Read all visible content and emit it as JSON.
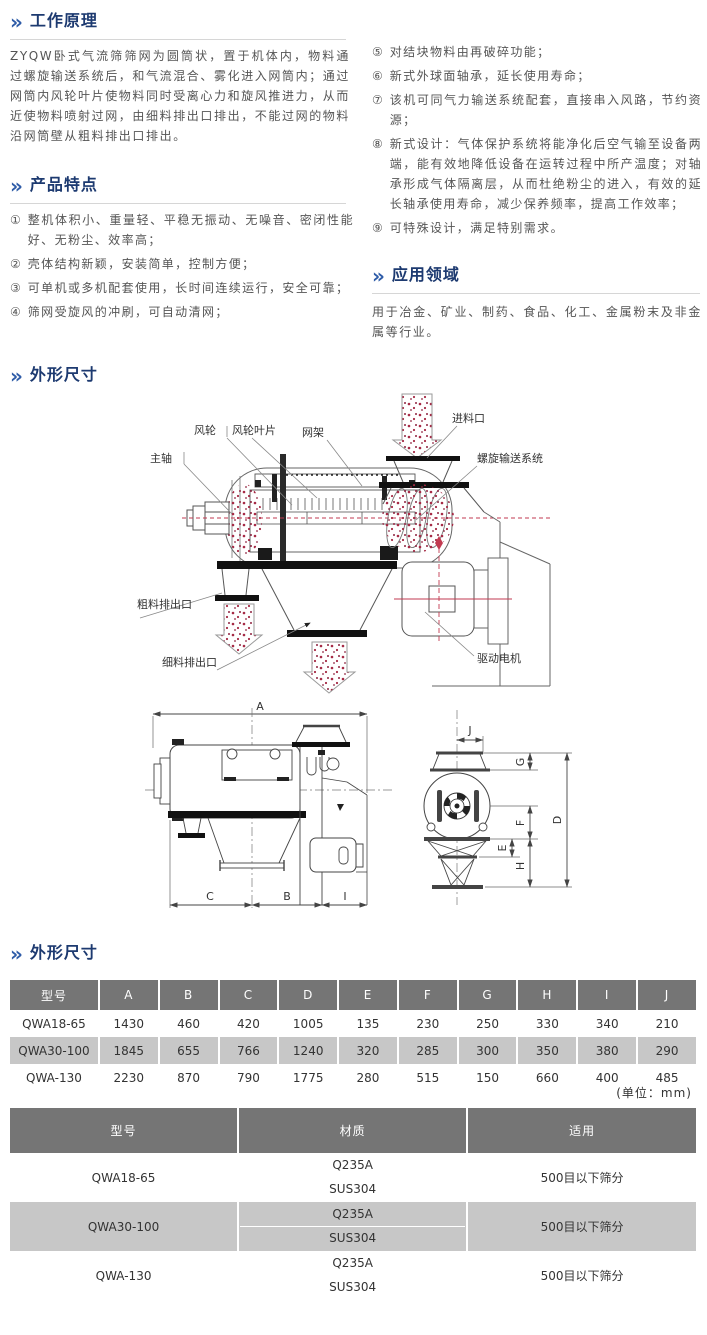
{
  "icons": {
    "chevron": "»"
  },
  "colors": {
    "heading": "#1d3a70",
    "chevron_blue": "#2e5ca8",
    "table_header_bg": "#757575",
    "table_row_gray": "#c7c7c7",
    "red_accent": "#c23a50"
  },
  "sections": {
    "working_principle": {
      "title": "工作原理",
      "body": "ZYQW卧式气流筛筛网为圆筒状，置于机体内，物料通过螺旋输送系统后，和气流混合、雾化进入网筒内；通过网筒内风轮叶片使物料同时受离心力和旋风推进力，从而近使物料喷射过网，由细料排出口排出，不能过网的物料沿网筒壁从粗料排出口排出。"
    },
    "features": {
      "title": "产品特点",
      "items": [
        {
          "marker": "①",
          "text": "整机体积小、重量轻、平稳无振动、无噪音、密闭性能好、无粉尘、效率高；"
        },
        {
          "marker": "②",
          "text": "壳体结构新颖，安装简单，控制方便；"
        },
        {
          "marker": "③",
          "text": "可单机或多机配套使用，长时间连续运行，安全可靠；"
        },
        {
          "marker": "④",
          "text": "筛网受旋风的冲刷，可自动清网；"
        },
        {
          "marker": "⑤",
          "text": "对结块物料由再破碎功能；"
        },
        {
          "marker": "⑥",
          "text": "新式外球面轴承，延长使用寿命；"
        },
        {
          "marker": "⑦",
          "text": "该机可同气力输送系统配套，直接串入风路，节约资源；"
        },
        {
          "marker": "⑧",
          "text": "新式设计：气体保护系统将能净化后空气输至设备两端，能有效地降低设备在运转过程中所产温度；对轴承形成气体隔离层，从而杜绝粉尘的进入，有效的延长轴承使用寿命，减少保养频率，提高工作效率；"
        },
        {
          "marker": "⑨",
          "text": "可特殊设计，满足特别需求。"
        }
      ]
    },
    "applications": {
      "title": "应用领域",
      "body": "用于冶金、矿业、制药、食品、化工、金属粉末及非金属等行业。"
    },
    "outline_dims": {
      "title": "外形尺寸"
    },
    "outline_dims2": {
      "title": "外形尺寸"
    }
  },
  "diagram1": {
    "labels": {
      "main_shaft": "主轴",
      "wind_wheel": "风轮",
      "wind_wheel_blades": "风轮叶片",
      "net_frame": "网架",
      "feed_inlet": "进料口",
      "screw_conveyor": "螺旋输送系统",
      "coarse_outlet": "粗料排出口",
      "fine_outlet": "细料排出口",
      "drive_motor": "驱动电机"
    }
  },
  "diagram2": {
    "letters": [
      "A",
      "B",
      "C",
      "D",
      "E",
      "F",
      "G",
      "H",
      "I",
      "J"
    ]
  },
  "dim_table": {
    "headers": [
      "型号",
      "A",
      "B",
      "C",
      "D",
      "E",
      "F",
      "G",
      "H",
      "I",
      "J"
    ],
    "rows": [
      {
        "model": "QWA18-65",
        "values": [
          "1430",
          "460",
          "420",
          "1005",
          "135",
          "230",
          "250",
          "330",
          "340",
          "210"
        ]
      },
      {
        "model": "QWA30-100",
        "values": [
          "1845",
          "655",
          "766",
          "1240",
          "320",
          "285",
          "300",
          "350",
          "380",
          "290"
        ]
      },
      {
        "model": "QWA-130",
        "values": [
          "2230",
          "870",
          "790",
          "1775",
          "280",
          "515",
          "150",
          "660",
          "400",
          "485"
        ]
      }
    ],
    "unit_note": "(单位：mm)"
  },
  "spec_table": {
    "headers": [
      "型号",
      "材质",
      "适用"
    ],
    "rows": [
      {
        "model": "QWA18-65",
        "materials": [
          "Q235A",
          "SUS304"
        ],
        "application": "500目以下筛分"
      },
      {
        "model": "QWA30-100",
        "materials": [
          "Q235A",
          "SUS304"
        ],
        "application": "500目以下筛分"
      },
      {
        "model": "QWA-130",
        "materials": [
          "Q235A",
          "SUS304"
        ],
        "application": "500目以下筛分"
      }
    ]
  }
}
